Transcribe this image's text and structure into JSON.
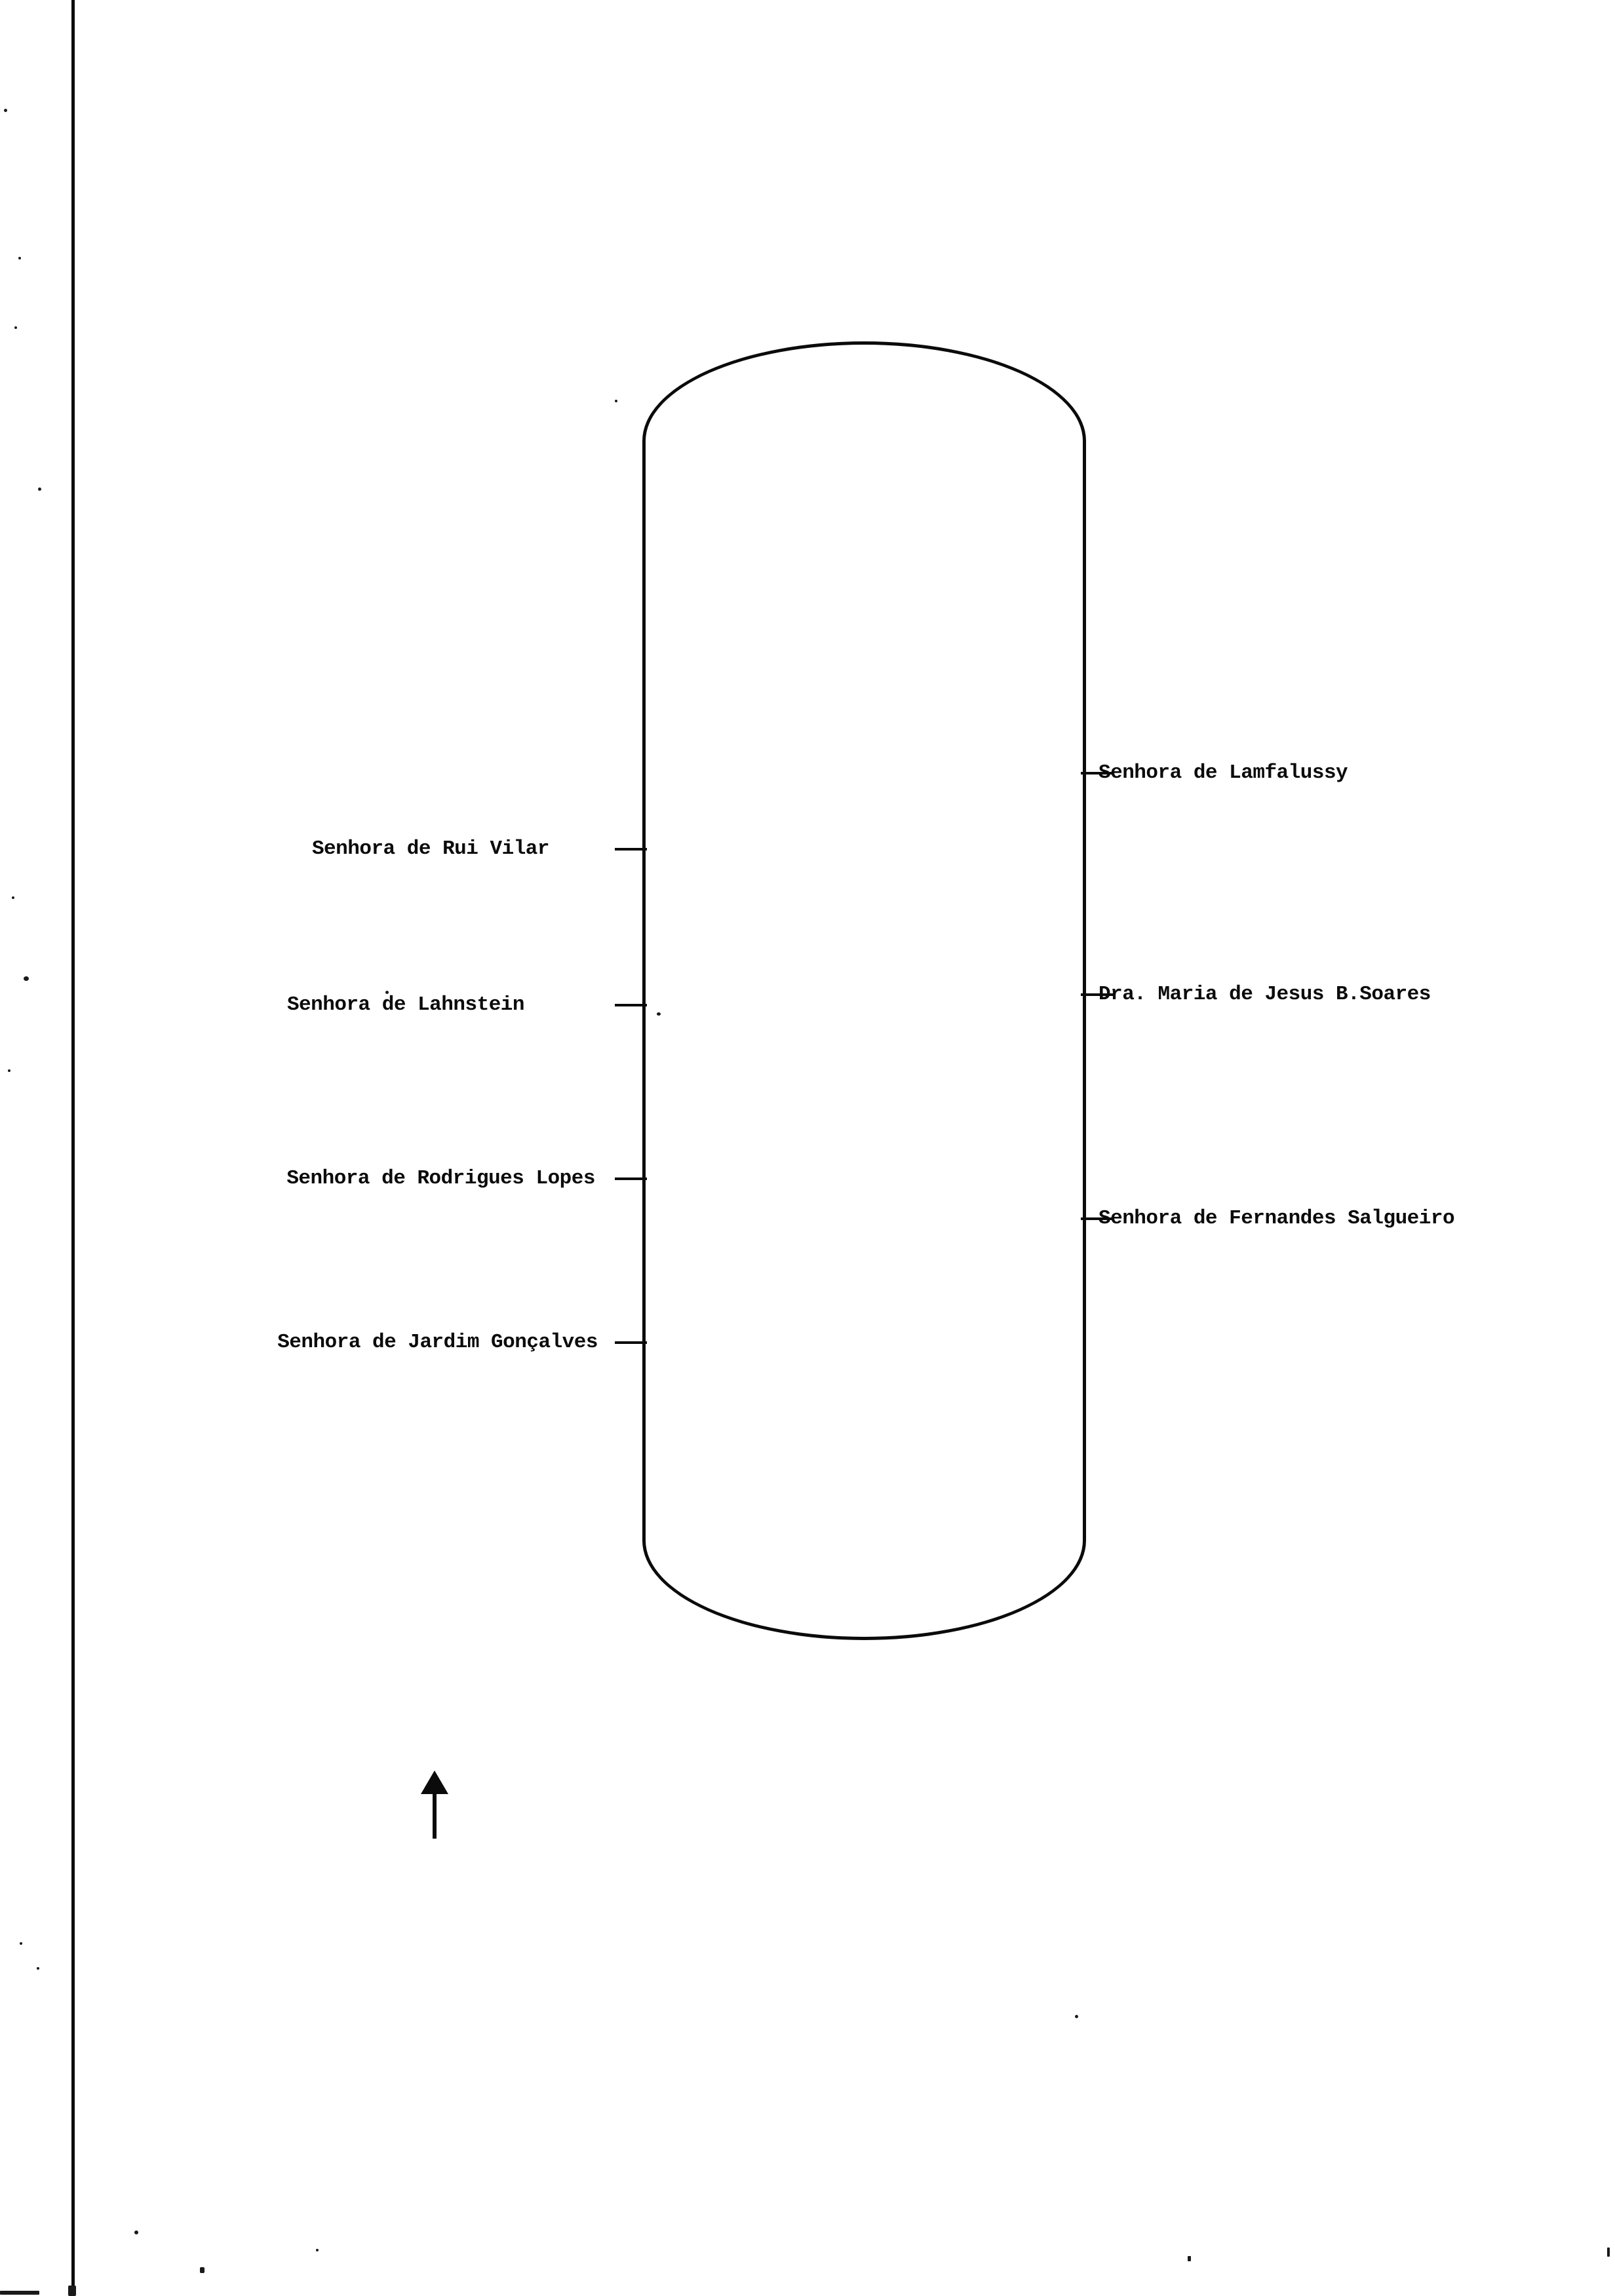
{
  "page": {
    "background_color": "#ffffff",
    "ink_color": "#0b0b0b"
  },
  "seating_diagram": {
    "table_shape": "oval-table-outline",
    "orientation_icon": "up-arrow",
    "left_seats": [
      {
        "label": "Senhora de Rui Vilar"
      },
      {
        "label": "Senhora de Lahnstein"
      },
      {
        "label": "Senhora de Rodrigues Lopes"
      },
      {
        "label": "Senhora de Jardim Gonçalves"
      }
    ],
    "right_seats": [
      {
        "label": "Senhora de Lamfalussy"
      },
      {
        "label": "Dra. Maria de Jesus B.Soares"
      },
      {
        "label": "Senhora de Fernandes Salgueiro"
      }
    ]
  }
}
